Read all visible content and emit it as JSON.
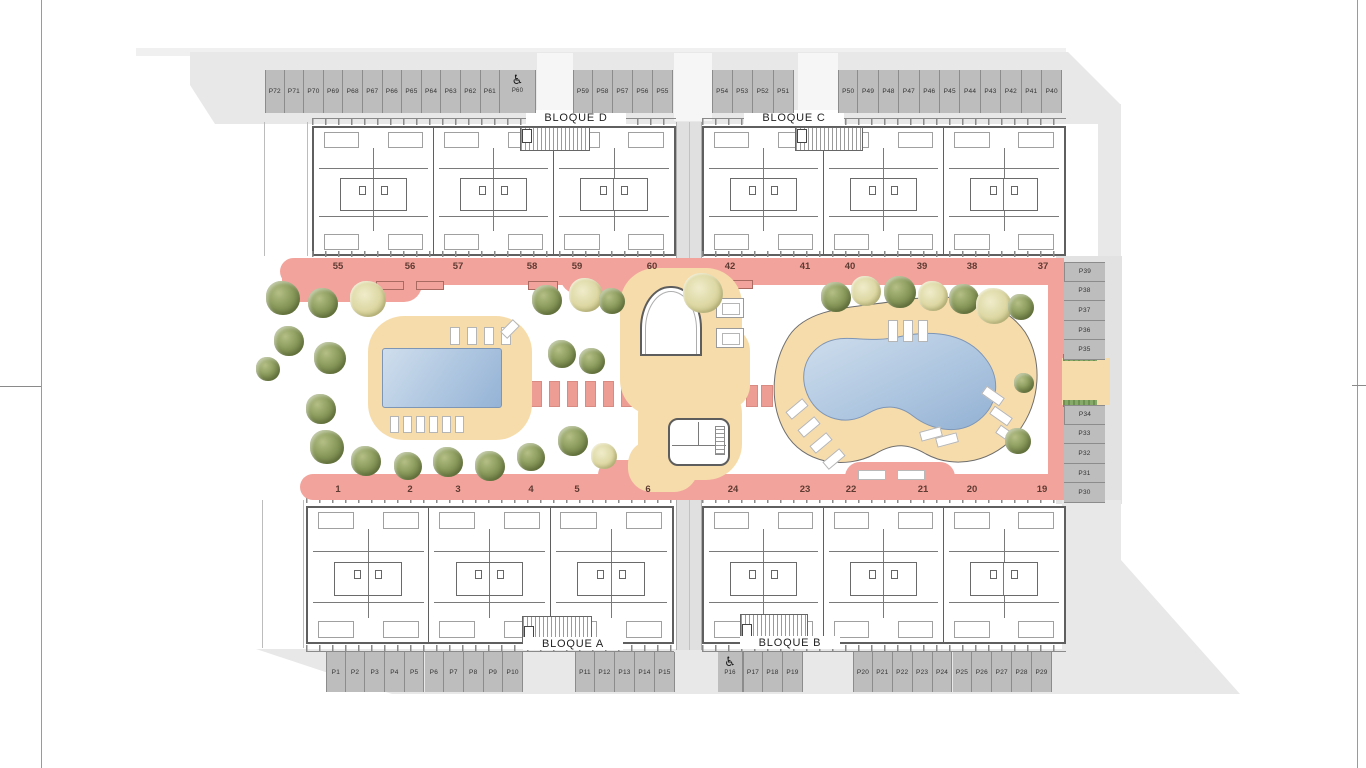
{
  "site": {
    "block_labels": {
      "d": "BLOQUE D",
      "c": "BLOQUE C",
      "a": "BLOQUE A",
      "b": "BLOQUE B"
    },
    "unit_numbers": {
      "top_left": [
        "55",
        "56",
        "57",
        "58",
        "59",
        "60"
      ],
      "top_right": [
        "42",
        "41",
        "40",
        "39",
        "38",
        "37"
      ],
      "bottom_left": [
        "1",
        "2",
        "3",
        "4",
        "5",
        "6"
      ],
      "bottom_right": [
        "24",
        "23",
        "22",
        "21",
        "20",
        "19"
      ]
    },
    "parking_groups": {
      "top_left": [
        "P72",
        "P71",
        "P70",
        "P69",
        "P68",
        "P67",
        "P66",
        "P65",
        "P64",
        "P63",
        "P62",
        "P61"
      ],
      "top_accessible": "P60",
      "top_mid": [
        "P59",
        "P58",
        "P57",
        "P56",
        "P55"
      ],
      "top_right_small": [
        "P54",
        "P53",
        "P52",
        "P51"
      ],
      "top_right": [
        "P50",
        "P49",
        "P48",
        "P47",
        "P46",
        "P45",
        "P44",
        "P43",
        "P42",
        "P41",
        "P40"
      ],
      "right_upper": [
        "P39",
        "P38",
        "P37",
        "P36",
        "P35"
      ],
      "right_lower": [
        "P34",
        "P33",
        "P32",
        "P31",
        "P30"
      ],
      "bottom_left": [
        "P1",
        "P2",
        "P3",
        "P4",
        "P5",
        "P6",
        "P7",
        "P8",
        "P9",
        "P10"
      ],
      "bottom_left_mid": [
        "P11",
        "P12",
        "P13",
        "P14",
        "P15"
      ],
      "bottom_accessible": "P16",
      "bottom_mid": [
        "P17",
        "P18",
        "P19"
      ],
      "bottom_right": [
        "P20",
        "P21",
        "P22",
        "P23",
        "P24",
        "P25",
        "P26",
        "P27",
        "P28",
        "P29"
      ]
    },
    "accessible_icon": "♿",
    "colors": {
      "path_pink": "#f2a49c",
      "deck_tan": "#f7dcab",
      "pool_blue": "#aec6e0",
      "parking_gray": "#bdbdbd",
      "site_gray": "#e8e8e8"
    }
  }
}
